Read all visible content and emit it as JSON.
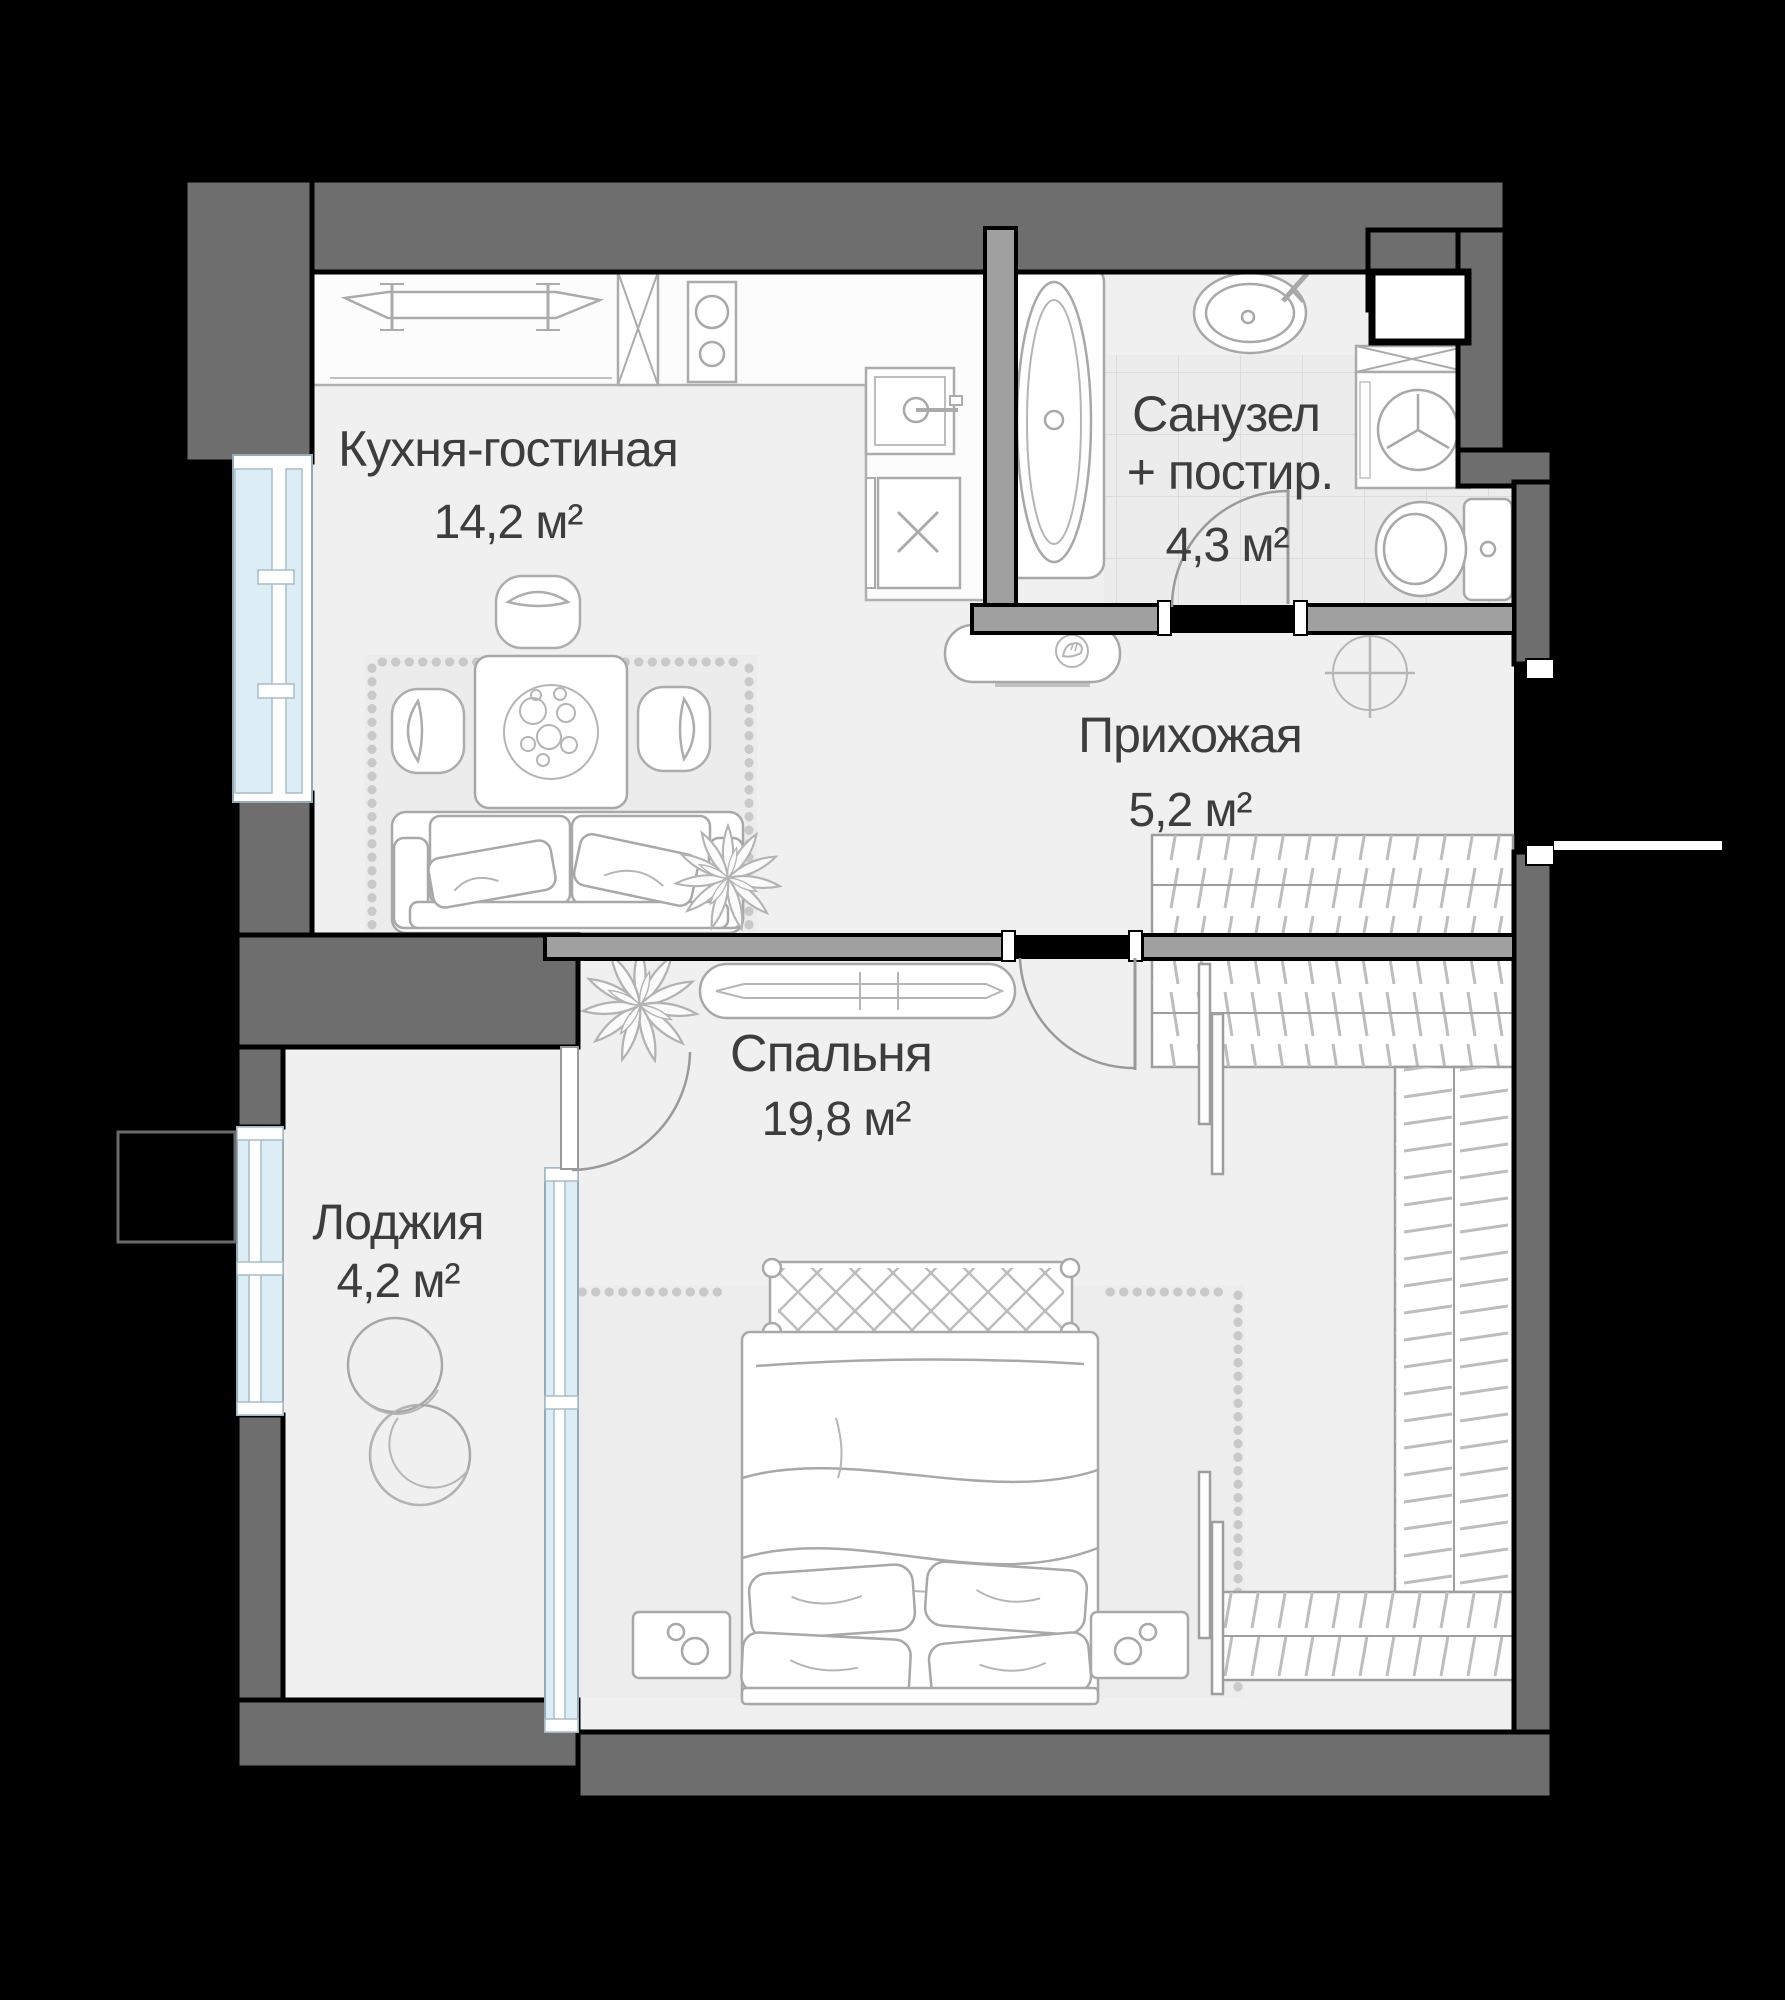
{
  "rooms": [
    {
      "id": "kitchen-living",
      "name": "Кухня-гостиная",
      "area": "14,2 м²"
    },
    {
      "id": "bathroom",
      "name_line1": "Санузел",
      "name_line2": "+ постир.",
      "area": "4,3 м²"
    },
    {
      "id": "hallway",
      "name": "Прихожая",
      "area": "5,2 м²"
    },
    {
      "id": "bedroom",
      "name": "Спальня",
      "area": "19,8 м²"
    },
    {
      "id": "loggia",
      "name": "Лоджия",
      "area": "4,2 м²"
    }
  ],
  "colors": {
    "background": "#000000",
    "outer_wall": "#6e6e6e",
    "partition_wall": "#a0a0a0",
    "floor": "#f0f0f0",
    "bath_tile": "#ececec",
    "window_glass": "#ddedf6",
    "furniture_line": "#a8a8a8",
    "label_text": "#3d3d3d"
  }
}
